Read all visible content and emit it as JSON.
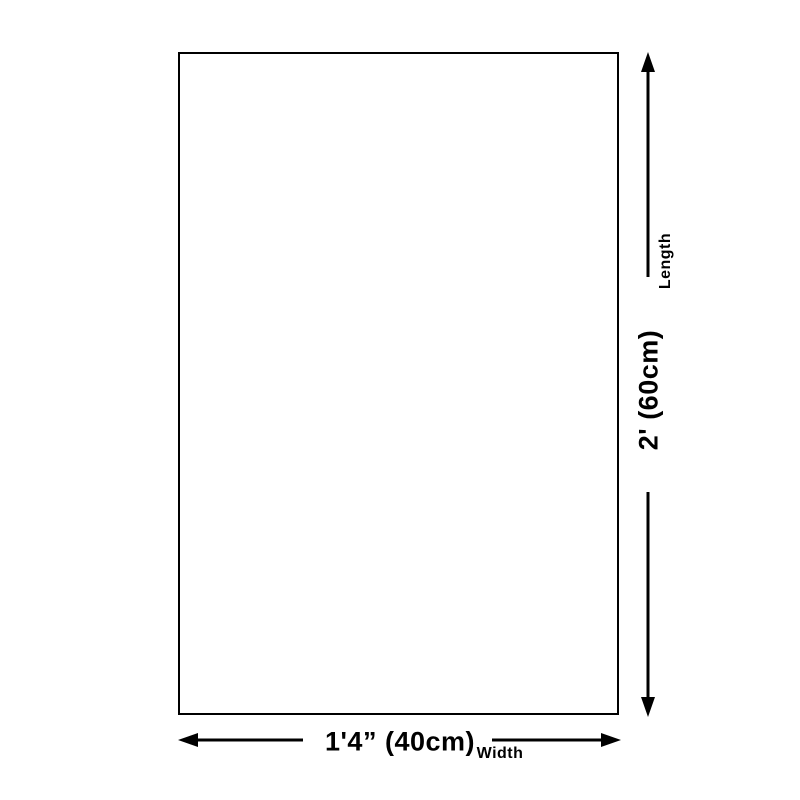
{
  "page": {
    "background_color": "#ffffff",
    "line_color": "#000000",
    "text_color": "#000000"
  },
  "diagram": {
    "shape": "rectangle-outline",
    "length": {
      "value": "2' (60cm)",
      "label": "Length"
    },
    "width": {
      "value": "1'4” (40cm)",
      "label": "Width"
    }
  }
}
